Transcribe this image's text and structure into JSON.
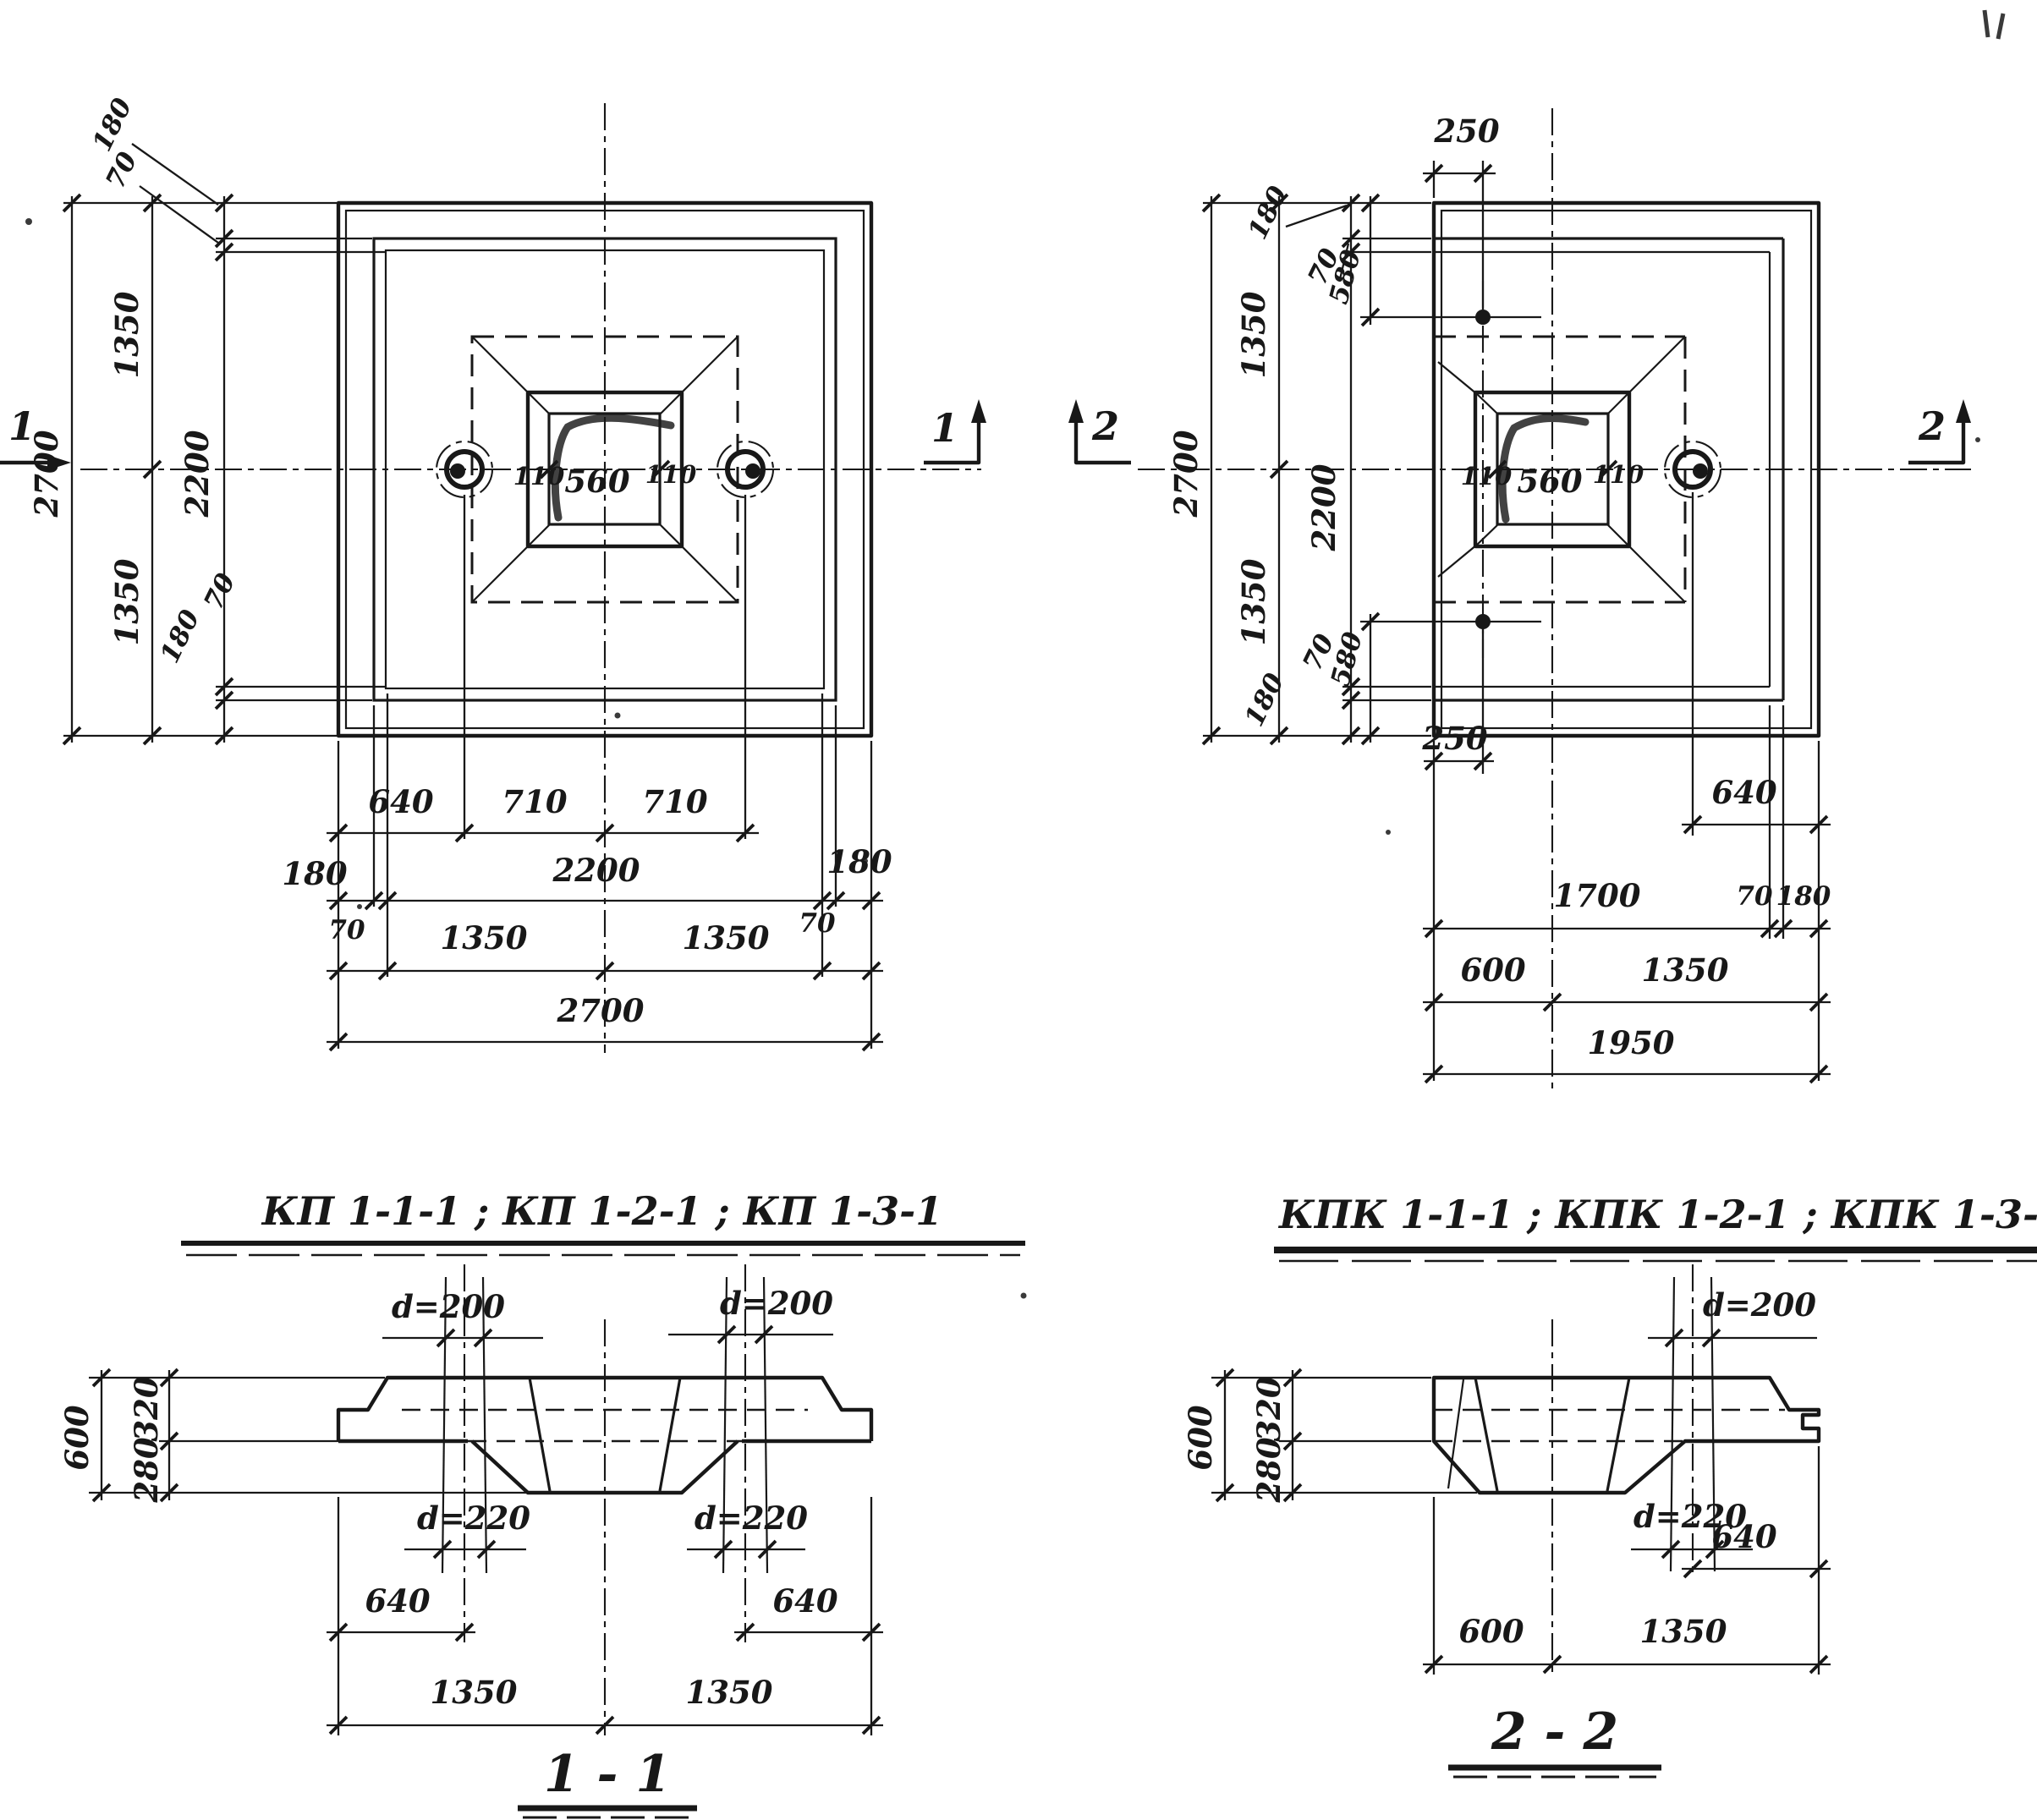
{
  "colors": {
    "ink": "#181818",
    "paper": "#ffffff"
  },
  "titles": {
    "group_left": "КП 1-1-1 ; КП 1-2-1 ; КП 1-3-1",
    "group_right": "КПК 1-1-1 ; КПК 1-2-1 ; КПК 1-3-1",
    "section_left": "1 - 1",
    "section_right": "2 - 2"
  },
  "plan_kp": {
    "v_2700": "2700",
    "v_1350_top": "1350",
    "v_1350_bot": "1350",
    "v_2200": "2200",
    "v_180_top": "180",
    "v_70_top": "70",
    "v_70_bot": "70",
    "v_180_bot": "180",
    "socket_560": "560",
    "socket_110_left": "110",
    "socket_110_right": "110",
    "b_640": "640",
    "b_710_left": "710",
    "b_710_right": "710",
    "b_180_left": "180",
    "b_2200": "2200",
    "b_180_right": "180",
    "b_70_left": "70",
    "b_1350_left": "1350",
    "b_1350_right": "1350",
    "b_70_right": "70",
    "b_2700": "2700",
    "marker_left": "1",
    "marker_right": "1"
  },
  "plan_kpk": {
    "t_250": "250",
    "v_2700": "2700",
    "v_1350_top": "1350",
    "v_1350_bot": "1350",
    "v_2200": "2200",
    "v_180_top": "180",
    "v_70_top": "70",
    "v_580_top": "580",
    "v_580_bot": "580",
    "v_70_bot": "70",
    "v_180_bot": "180",
    "b_250": "250",
    "socket_560": "560",
    "socket_110_left": "110",
    "socket_110_right": "110",
    "r_640": "640",
    "b_1700": "1700",
    "b_70": "70",
    "b_180": "180",
    "b_600": "600",
    "b_1350": "1350",
    "b_1950": "1950",
    "marker_left": "2",
    "marker_right": "2"
  },
  "section_1_1": {
    "d200_left": "d=200",
    "d200_right": "d=200",
    "d220_left": "d=220",
    "d220_right": "d=220",
    "h_600": "600",
    "h_320": "320",
    "h_280": "280",
    "b_640_left": "640",
    "b_640_right": "640",
    "b_1350_left": "1350",
    "b_1350_right": "1350"
  },
  "section_2_2": {
    "d200": "d=200",
    "d220": "d=220",
    "h_600": "600",
    "h_320": "320",
    "h_280": "280",
    "b_600": "600",
    "b_1350": "1350",
    "b_640": "640"
  }
}
